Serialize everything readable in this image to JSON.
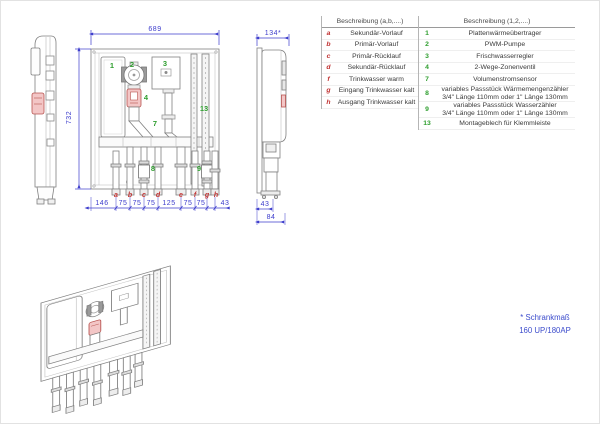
{
  "colors": {
    "dimension_blue": "#3c3ccc",
    "label_red": "#c03030",
    "label_green": "#2e9e2e",
    "highlight_red_fill": "#f3c6c6",
    "highlight_red_stroke": "#b85450",
    "drawing_gray": "#808080"
  },
  "views": {
    "front": {
      "width_dim": "689",
      "height_dim": "732",
      "port_labels": [
        "a",
        "b",
        "c",
        "d",
        "e",
        "f",
        "g",
        "h"
      ],
      "bottom_dims": [
        "146",
        "75",
        "75",
        "75",
        "125",
        "75",
        "75",
        "43"
      ],
      "component_labels": [
        "1",
        "2",
        "3",
        "4",
        "7",
        "8",
        "9",
        "13"
      ]
    },
    "side_right": {
      "depth_dim": "134*",
      "bottom_dim_inner": "43",
      "bottom_dim_outer": "84"
    }
  },
  "tables": {
    "letters": {
      "header": "Beschreibung (a,b,....)",
      "rows": [
        {
          "key": "a",
          "desc": "Sekundär-Vorlauf"
        },
        {
          "key": "b",
          "desc": "Primär-Vorlauf"
        },
        {
          "key": "c",
          "desc": "Primär-Rücklauf"
        },
        {
          "key": "d",
          "desc": "Sekundär-Rücklauf"
        },
        {
          "key": "f",
          "desc": "Trinkwasser warm"
        },
        {
          "key": "g",
          "desc": "Eingang Trinkwasser kalt"
        },
        {
          "key": "h",
          "desc": "Ausgang Trinkwasser kalt"
        }
      ]
    },
    "numbers": {
      "header": "Beschreibung (1,2,....)",
      "rows": [
        {
          "key": "1",
          "desc": "Plattenwärmeübertrager"
        },
        {
          "key": "2",
          "desc": "PWM-Pumpe"
        },
        {
          "key": "3",
          "desc": "Frischwasserregler"
        },
        {
          "key": "4",
          "desc": "2-Wege-Zonenventil"
        },
        {
          "key": "7",
          "desc": "Volumenstromsensor"
        },
        {
          "key": "8",
          "desc": "variables Passstück Wärmemengenzähler",
          "desc2": "3/4\" Länge 110mm oder 1\" Länge 130mm"
        },
        {
          "key": "9",
          "desc": "variables Passstück Wasserzähler",
          "desc2": "3/4\" Länge 110mm oder 1\" Länge 130mm"
        },
        {
          "key": "13",
          "desc": "Montageblech für Klemmleiste"
        }
      ]
    }
  },
  "note": {
    "line1": "* Schrankmaß",
    "line2": "160 UP/180AP"
  }
}
